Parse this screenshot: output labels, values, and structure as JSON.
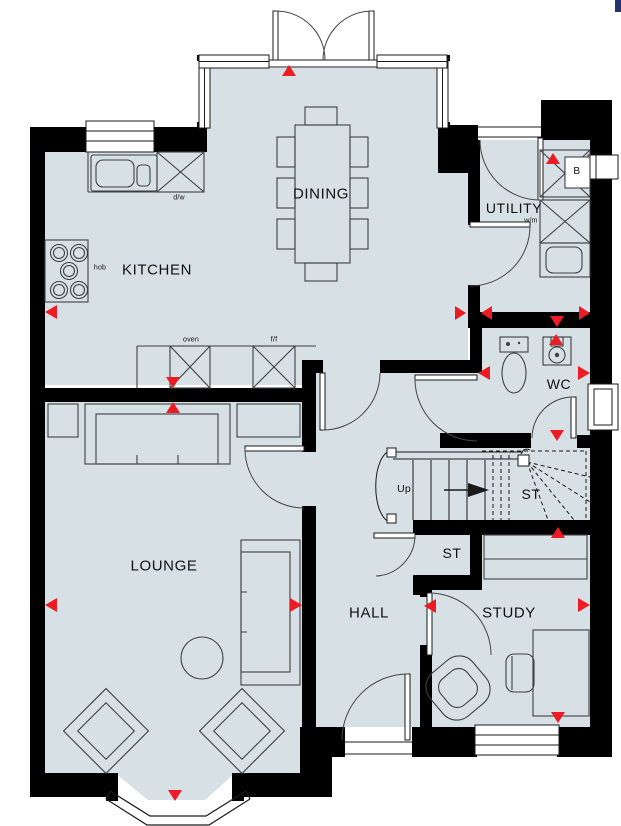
{
  "plan": {
    "labels": {
      "kitchen": "KITCHEN",
      "dining": "DINING",
      "utility": "UTILITY",
      "wc": "WC",
      "lounge": "LOUNGE",
      "hall": "HALL",
      "study": "STUDY",
      "stair_store": "ST",
      "hall_store": "ST",
      "up": "Up",
      "hob": "hob",
      "dishwasher": "d/w",
      "oven": "oven",
      "fridge_freezer": "f/f",
      "washing_machine": "w/m",
      "boiler": "B"
    },
    "colors": {
      "floor": "#d6e0e5",
      "wall": "#000000",
      "marker": "#ed1c24",
      "furniture": "#3c4043"
    }
  }
}
